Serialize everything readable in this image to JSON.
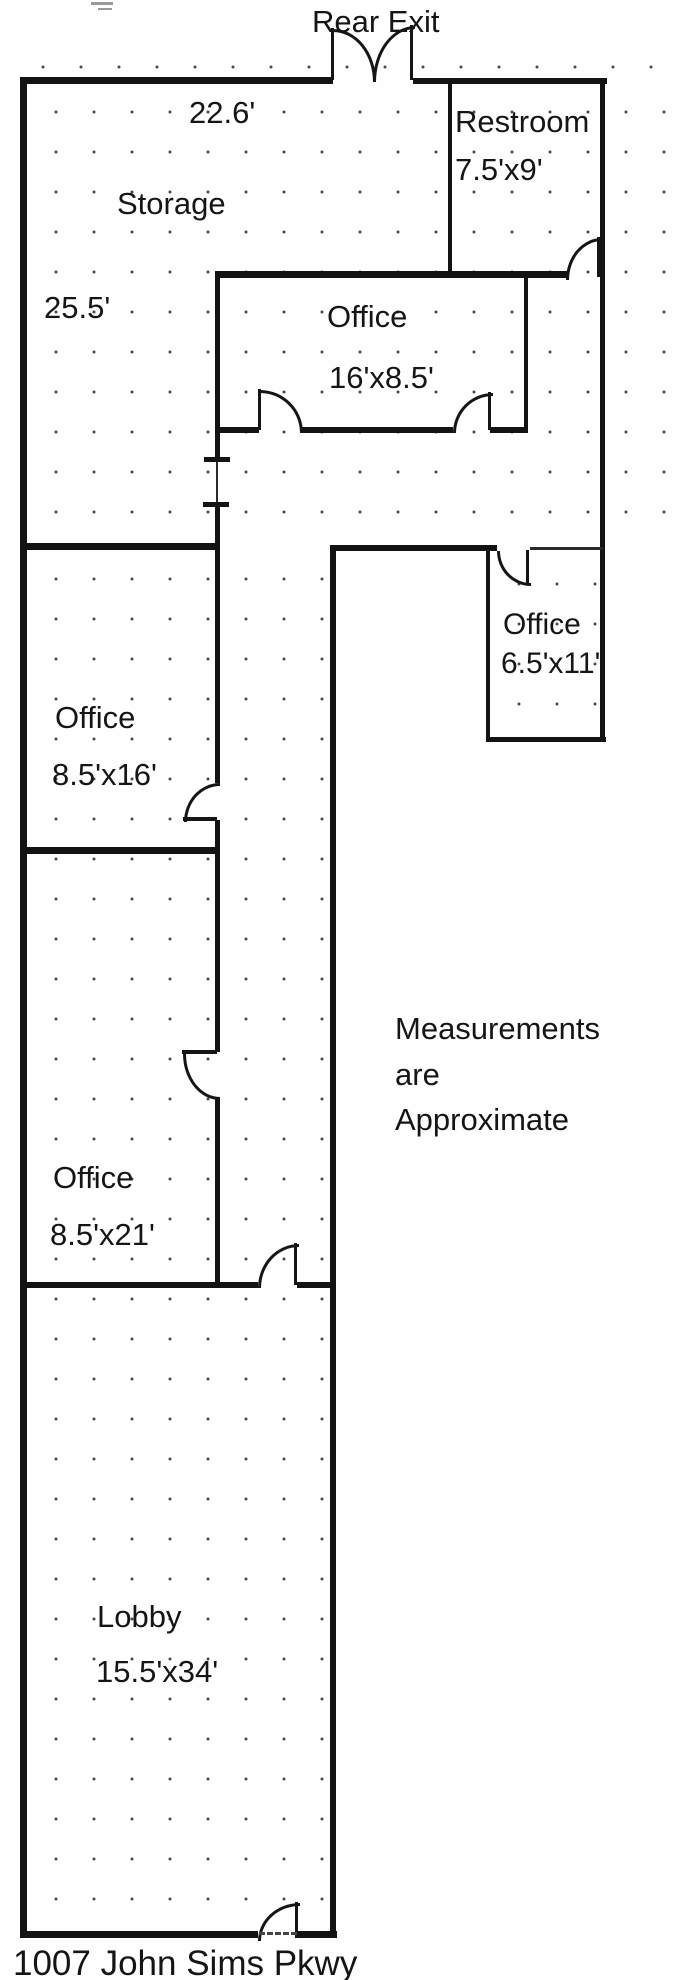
{
  "plan": {
    "rear_exit_label": "Rear Exit",
    "address": "1007 John Sims Pkwy",
    "note": {
      "line1": "Measurements",
      "line2": "are",
      "line3": "Approximate"
    },
    "rooms": {
      "storage": {
        "name": "Storage",
        "width_label": "22.6'",
        "depth_label": "25.5'"
      },
      "restroom": {
        "name": "Restroom",
        "dims": "7.5'x9'"
      },
      "office_center": {
        "name": "Office",
        "dims": "16'x8.5'"
      },
      "office_right": {
        "name": "Office",
        "dims": "6.5'x11'"
      },
      "office_left_upper": {
        "name": "Office",
        "dims": "8.5'x16'"
      },
      "office_left_lower": {
        "name": "Office",
        "dims": "8.5'x21'"
      },
      "lobby": {
        "name": "Lobby",
        "dims": "15.5'x34'"
      }
    }
  }
}
